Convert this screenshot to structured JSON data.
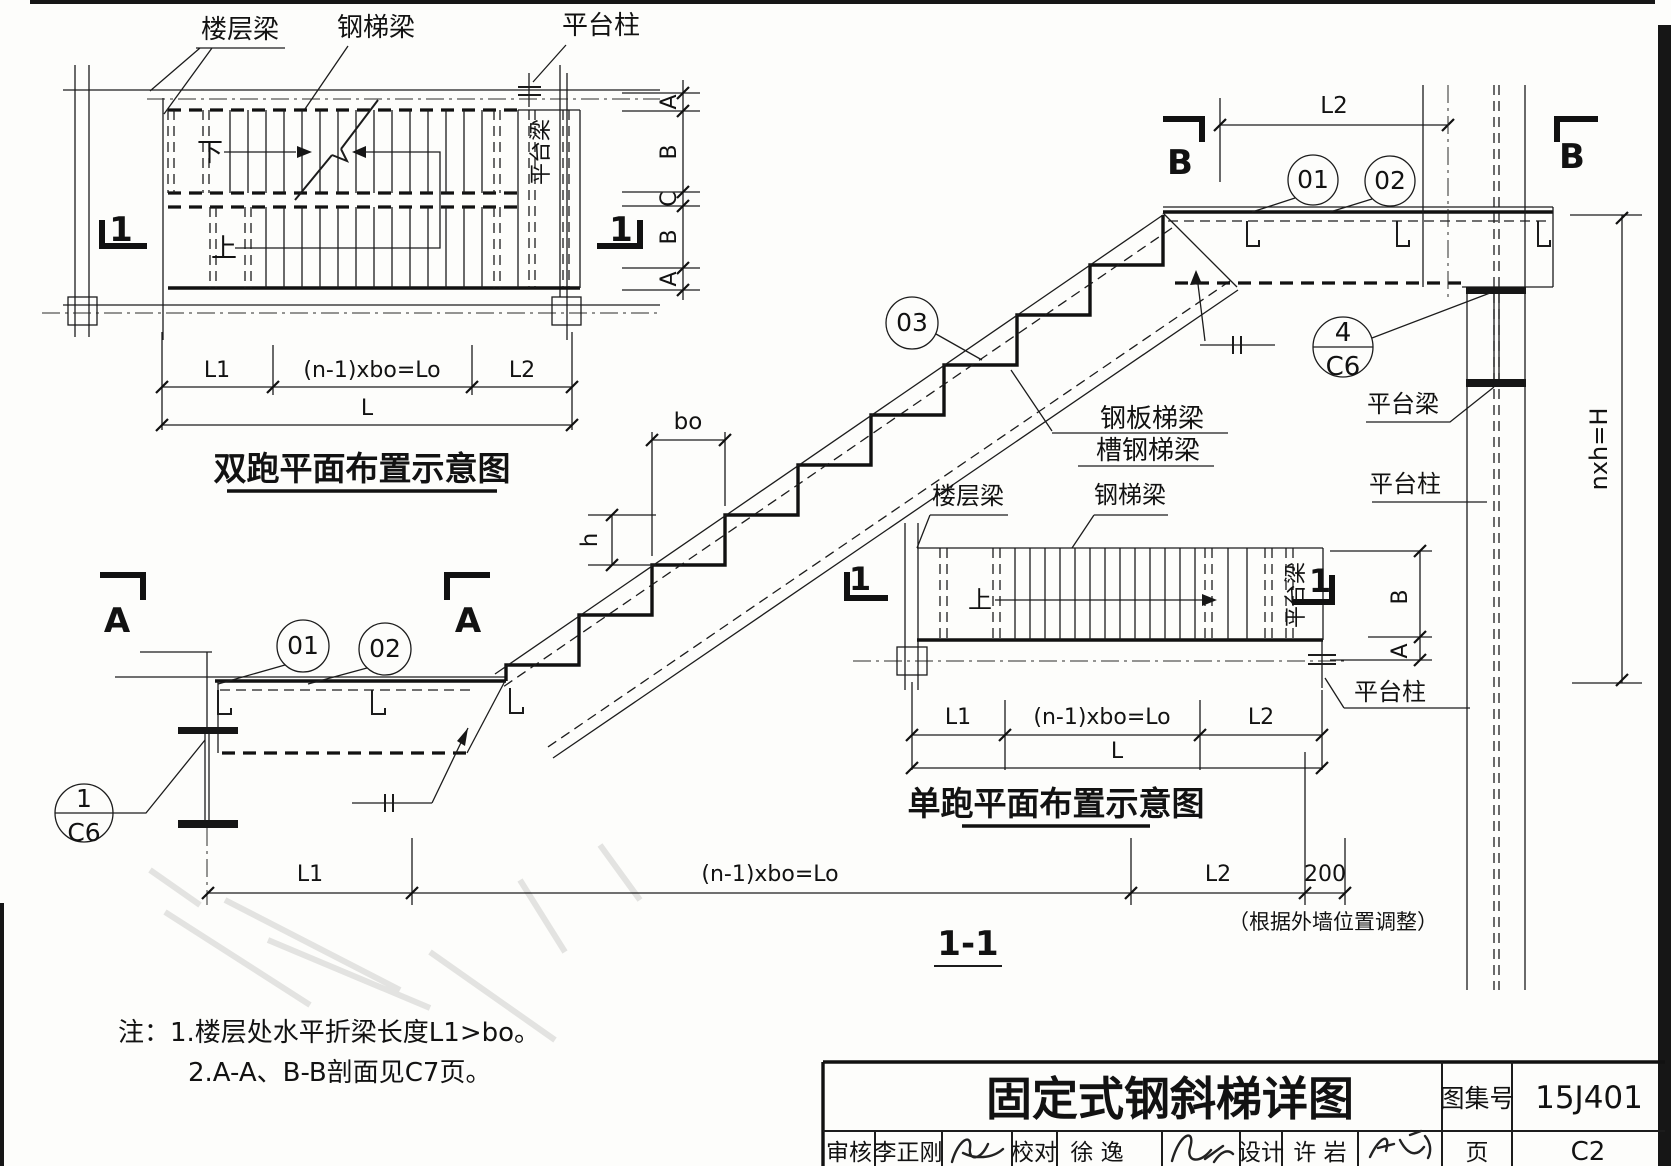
{
  "drawing": {
    "labels": {
      "floor_beam": "楼层梁",
      "steel_stair_beam": "钢梯梁",
      "platform_column": "平台柱",
      "platform_beam": "平台梁",
      "down": "下",
      "up": "上",
      "plate_stair_beam": "钢板梯梁",
      "channel_stair_beam": "槽钢梯梁"
    },
    "dims": {
      "L1": "L1",
      "Lo": "(n-1)xbo=Lo",
      "L2": "L2",
      "L": "L",
      "A": "A",
      "B": "B",
      "C": "C",
      "bo": "bo",
      "h": "h",
      "H": "nxh=H",
      "w200": "200",
      "wall_note": "（根据外墙位置调整）"
    },
    "marks": {
      "one": "1",
      "A": "A",
      "B": "B"
    },
    "callouts": {
      "c01": "01",
      "c02": "02",
      "c03": "03",
      "c4_num": "4",
      "c1_num": "1",
      "c6_page": "C6"
    },
    "titles": {
      "plan_double": "双跑平面布置示意图",
      "plan_single": "单跑平面布置示意图",
      "section_1_1": "1-1"
    },
    "notes": {
      "prefix": "注：",
      "line1": "1.楼层处水平折梁长度L1>bo。",
      "line2": "2.A-A、B-B剖面见C7页。"
    },
    "titleblock": {
      "title": "固定式钢斜梯详图",
      "atlas_label": "图集号",
      "atlas_no": "15J401",
      "page_label": "页",
      "page_no": "C2",
      "reviewer_label": "审核",
      "reviewer_name": "李正刚",
      "checker_label": "校对",
      "checker_name": "徐 逸",
      "designer_label": "设计",
      "designer_name": "许 岩"
    }
  }
}
